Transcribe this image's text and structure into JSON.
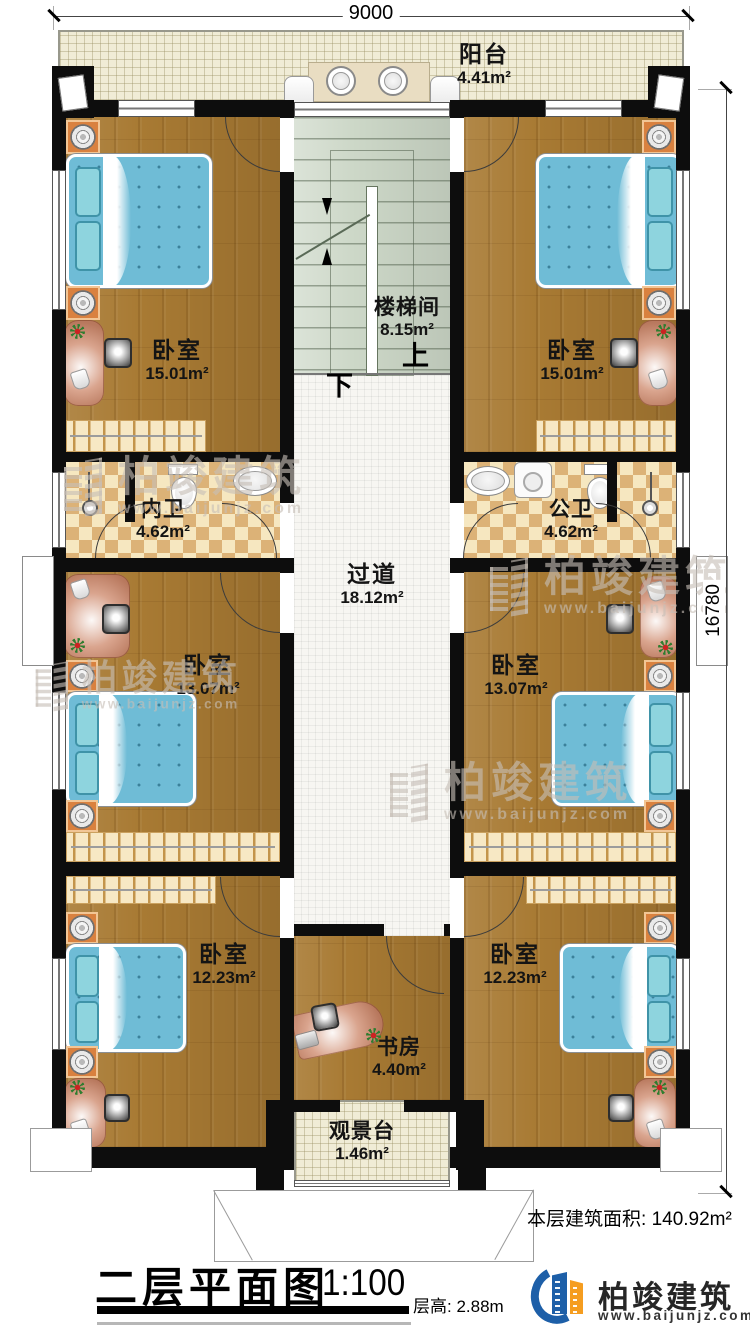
{
  "drawing": {
    "title": "二层平面图",
    "scale": "1:100",
    "floor_height": "层高: 2.88m",
    "floor_area_label": "本层建筑面积:",
    "floor_area_value": "140.92m²"
  },
  "dimensions": {
    "width_mm": "9000",
    "height_mm": "16780"
  },
  "rooms": {
    "balcony": {
      "name": "阳台",
      "area": "4.41m²"
    },
    "stairwell": {
      "name": "楼梯间",
      "area": "8.15m²",
      "up": "上",
      "down": "下"
    },
    "bedroom_tl": {
      "name": "卧室",
      "area": "15.01m²"
    },
    "bedroom_tr": {
      "name": "卧室",
      "area": "15.01m²"
    },
    "bath_left": {
      "name": "内卫",
      "area": "4.62m²"
    },
    "bath_right": {
      "name": "公卫",
      "area": "4.62m²"
    },
    "hallway": {
      "name": "过道",
      "area": "18.12m²"
    },
    "bedroom_ml": {
      "name": "卧室",
      "area": "13.07m²"
    },
    "bedroom_mr": {
      "name": "卧室",
      "area": "13.07m²"
    },
    "bedroom_bl": {
      "name": "卧室",
      "area": "12.23m²"
    },
    "bedroom_br": {
      "name": "卧室",
      "area": "12.23m²"
    },
    "study": {
      "name": "书房",
      "area": "4.40m²"
    },
    "deck": {
      "name": "观景台",
      "area": "1.46m²"
    }
  },
  "branding": {
    "company": "柏竣建筑",
    "website": "www.baijunjz.com"
  },
  "watermark": {
    "company": "柏竣建筑",
    "website": "www.baijunjz.com"
  },
  "colors": {
    "wall": "#0d0d0d",
    "wood": "#a87a33",
    "tile_light": "#f6e7c0",
    "tile_dark": "#dcb277",
    "stair": "#ccd7c7",
    "bed": "#6fbcd6",
    "logo_blue": "#1d5fa8",
    "logo_orange": "#f59d20"
  }
}
